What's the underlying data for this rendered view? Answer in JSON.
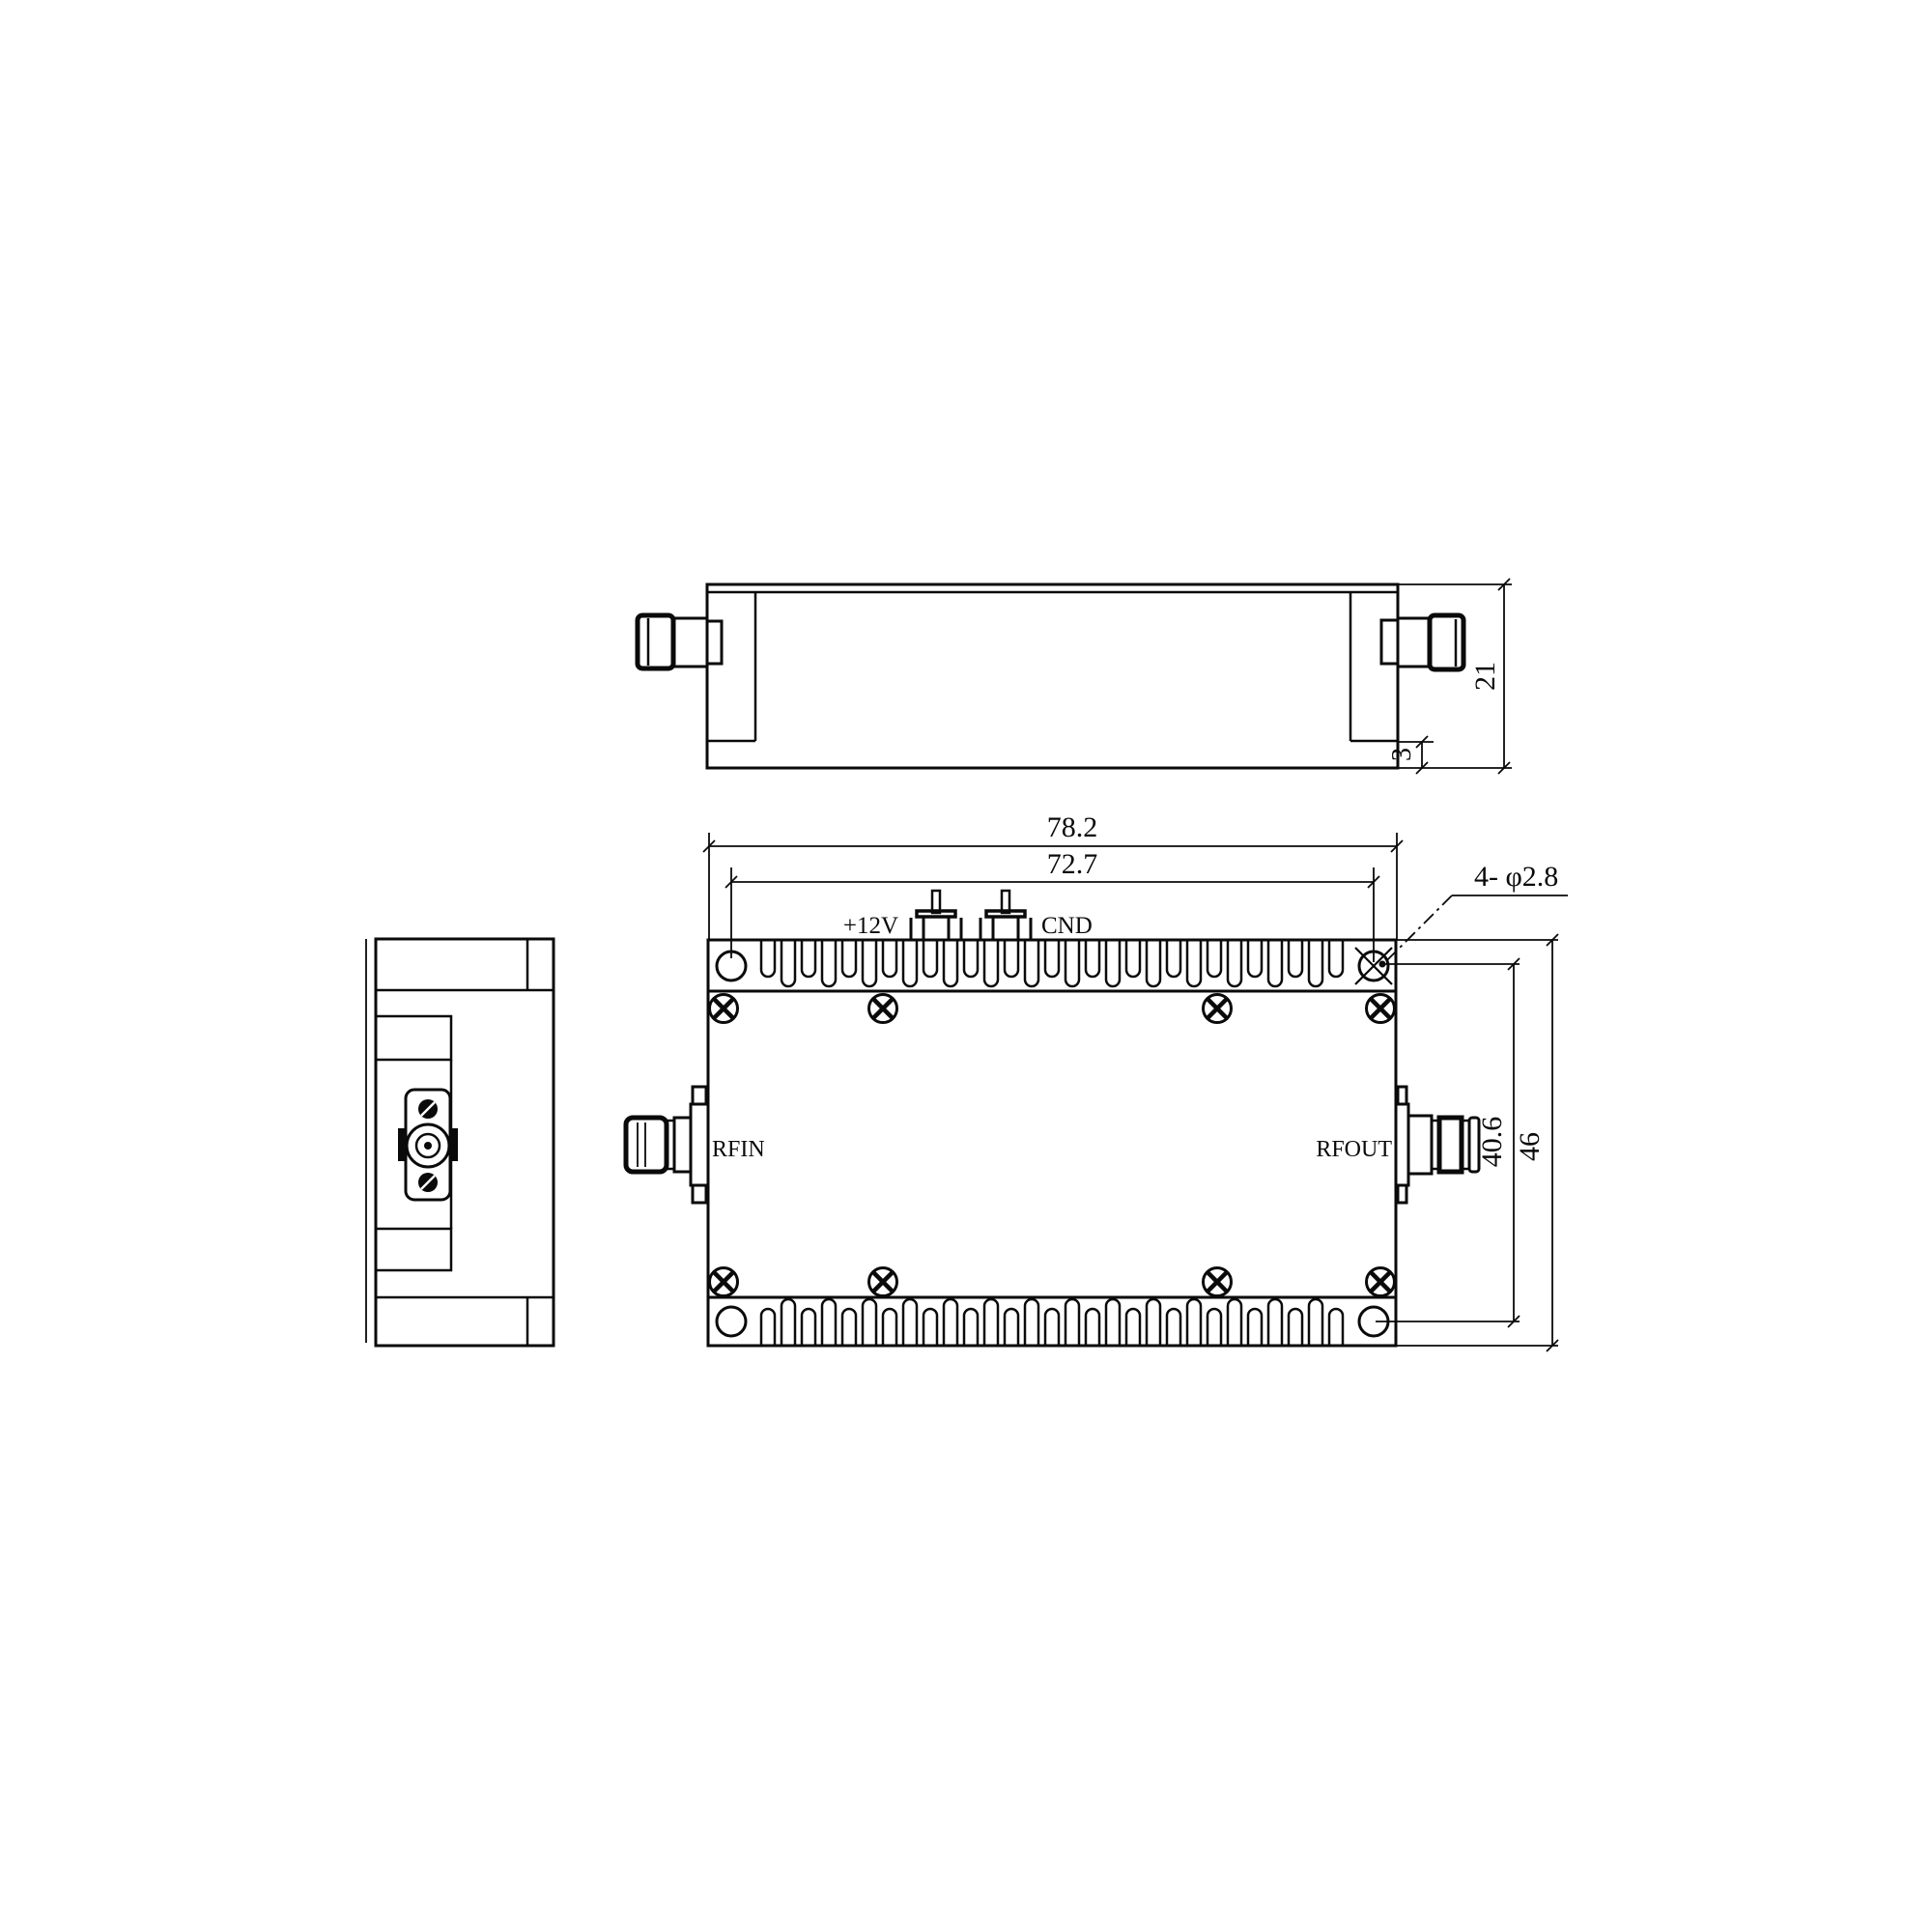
{
  "page": {
    "background": "#ffffff",
    "line_color": "#0a0a0a"
  },
  "dimensions": {
    "overall_length": "78.2",
    "hole_spacing_length": "72.7",
    "mounting_holes_note": "4- φ2.8",
    "hole_spacing_width": "40.6",
    "overall_width": "46",
    "overall_height": "21",
    "plate_thickness": "3"
  },
  "labels": {
    "power_pin": "+12V",
    "ground_pin": "CND",
    "rf_input": "RFIN",
    "rf_output": "RFOUT"
  }
}
